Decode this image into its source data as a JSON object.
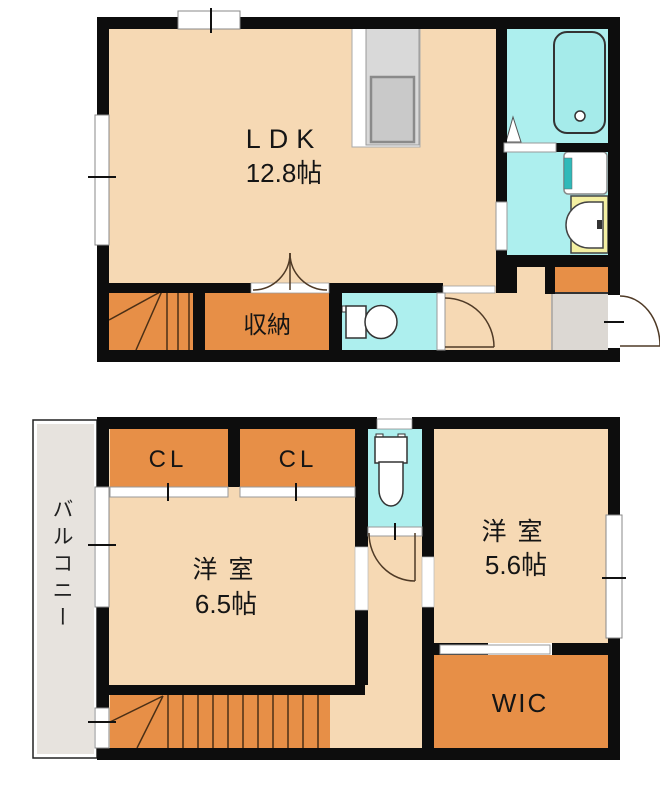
{
  "floor1": {
    "ldk_label": "LDK",
    "ldk_size": "12.8帖",
    "storage_label": "収納"
  },
  "floor2": {
    "cl_left_label": "CL",
    "cl_right_label": "CL",
    "room_main_label": "洋 室",
    "room_main_size": "6.5帖",
    "room_second_label": "洋 室",
    "room_second_size": "5.6帖",
    "wic_label": "WIC",
    "balcony_label": "バルコニー"
  },
  "colors": {
    "room_peach": "#f6d9b4",
    "closet_orange": "#e78f47",
    "wet_cyan": "#adefee",
    "tub_cyan": "#a5ebea",
    "vanity_yellow": "#f4f0a2",
    "washer_teal": "#2fb9b9",
    "balcony_gray": "#e7e3de",
    "entry_gray": "#dcd8d3",
    "counter_gray": "#d9d9d9",
    "sink_gray": "#c9c9c9",
    "wall_black": "#0d0d0d"
  }
}
